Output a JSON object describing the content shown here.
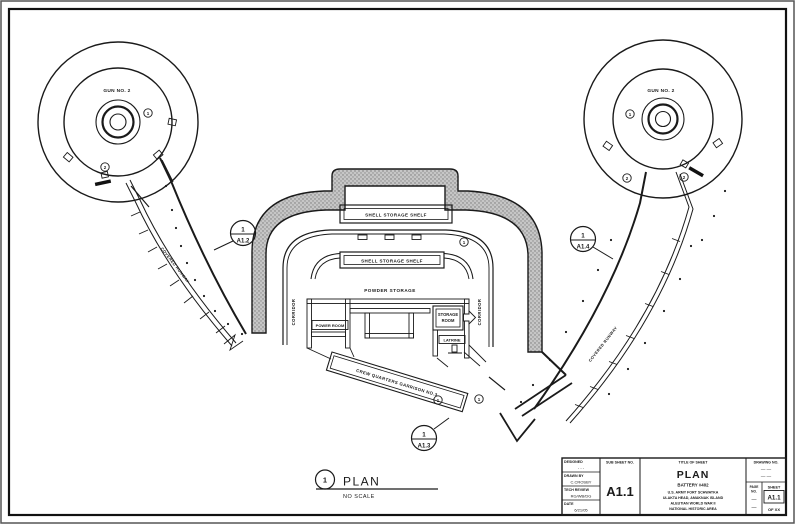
{
  "colors": {
    "ink": "#1a1a1a",
    "stipple": "#c6c6c6"
  },
  "plan": {
    "gun_left": "GUN NO. 2",
    "gun_right": "GUN NO. 2",
    "m1": "1",
    "m2": "2",
    "shell_shelf": "SHELL STORAGE SHELF",
    "powder": "POWDER STORAGE",
    "corridor": "CORRIDOR",
    "power_room": "POWER ROOM",
    "storage1": "STORAGE",
    "storage2": "ROOM",
    "latrine": "LATRINE",
    "crew": "CREW QUARTERS GARRISON NO.3",
    "runway": "COVERED RUNWAY",
    "callout_left_num": "1",
    "callout_left_sheet": "A1.2",
    "callout_right_num": "1",
    "callout_right_sheet": "A1.4",
    "callout_bottom_num": "1",
    "callout_bottom_sheet": "A1.3",
    "title_num": "1",
    "title": "PLAN",
    "scale": "NO SCALE"
  },
  "titleblock": {
    "designed_label": "DESIGNED",
    "designed_value": "- - -",
    "drawn_label": "DRAWN BY",
    "drawn_value": "C.CROSBY",
    "review_label": "TECH REVIEW",
    "review_value": "RG/WB/DG",
    "date_label": "DATE",
    "date_value": "6/21/05",
    "subsheet_label": "SUB SHEET NO.",
    "subsheet_value": "A1.1",
    "titleofsheet_label": "TITLE OF SHEET",
    "sheet_title": "PLAN",
    "battery": "BATTERY #402",
    "org1": "U.S. ARMY FORT SCHWATKA",
    "org2": "ULAKTA HEAD, AMAKNAK ISLAND",
    "org3": "ALEUTIAN WORLD WAR II",
    "org4": "NATIONAL HISTORIC AREA",
    "drawingno_label": "DRAWING NO.",
    "drawingno_dash1": "— —",
    "drawingno_dash2": "— —",
    "pageno_label1": "PAGE",
    "pageno_label2": "NO.",
    "pageno_dash1": "—",
    "pageno_dash2": "—",
    "sheet_label": "SHEET",
    "sheet_value": "A1.1",
    "of_value": "OF XX"
  }
}
